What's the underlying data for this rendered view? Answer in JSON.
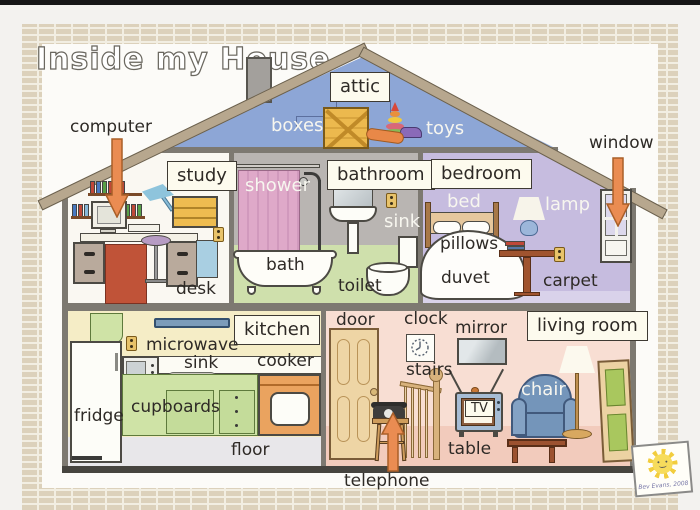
{
  "title": "Inside my House",
  "credit": "Bev Evans, 2008",
  "callouts": {
    "computer": "computer",
    "window": "window",
    "telephone": "telephone"
  },
  "rooms": {
    "attic": {
      "name": "attic",
      "items": {
        "boxes": "boxes",
        "toys": "toys"
      }
    },
    "study": {
      "name": "study",
      "items": {
        "desk": "desk"
      }
    },
    "bathroom": {
      "name": "bathroom",
      "items": {
        "shower": "shower",
        "sink": "sink",
        "bath": "bath",
        "toilet": "toilet"
      }
    },
    "bedroom": {
      "name": "bedroom",
      "items": {
        "bed": "bed",
        "lamp": "lamp",
        "pillows": "pillows",
        "duvet": "duvet",
        "carpet": "carpet"
      }
    },
    "kitchen": {
      "name": "kitchen",
      "items": {
        "microwave": "microwave",
        "sink": "sink",
        "cooker": "cooker",
        "fridge": "fridge",
        "cupboards": "cupboards",
        "floor": "floor"
      }
    },
    "living_room": {
      "name": "living room",
      "items": {
        "door": "door",
        "clock": "clock",
        "mirror": "mirror",
        "stairs": "stairs",
        "tv": "TV",
        "chair": "chair",
        "table": "table"
      }
    }
  },
  "colors": {
    "arrow": "#ea8c52",
    "roof": "#b7a78e",
    "attic_blue": "#8da6d6",
    "bathroom_grey": "#b9b5b2",
    "bedroom_lavender": "#c6bcdf",
    "kitchen_cream": "#f5edc6",
    "living_pink": "#f8ded3",
    "label_box": "#fdfbee"
  }
}
